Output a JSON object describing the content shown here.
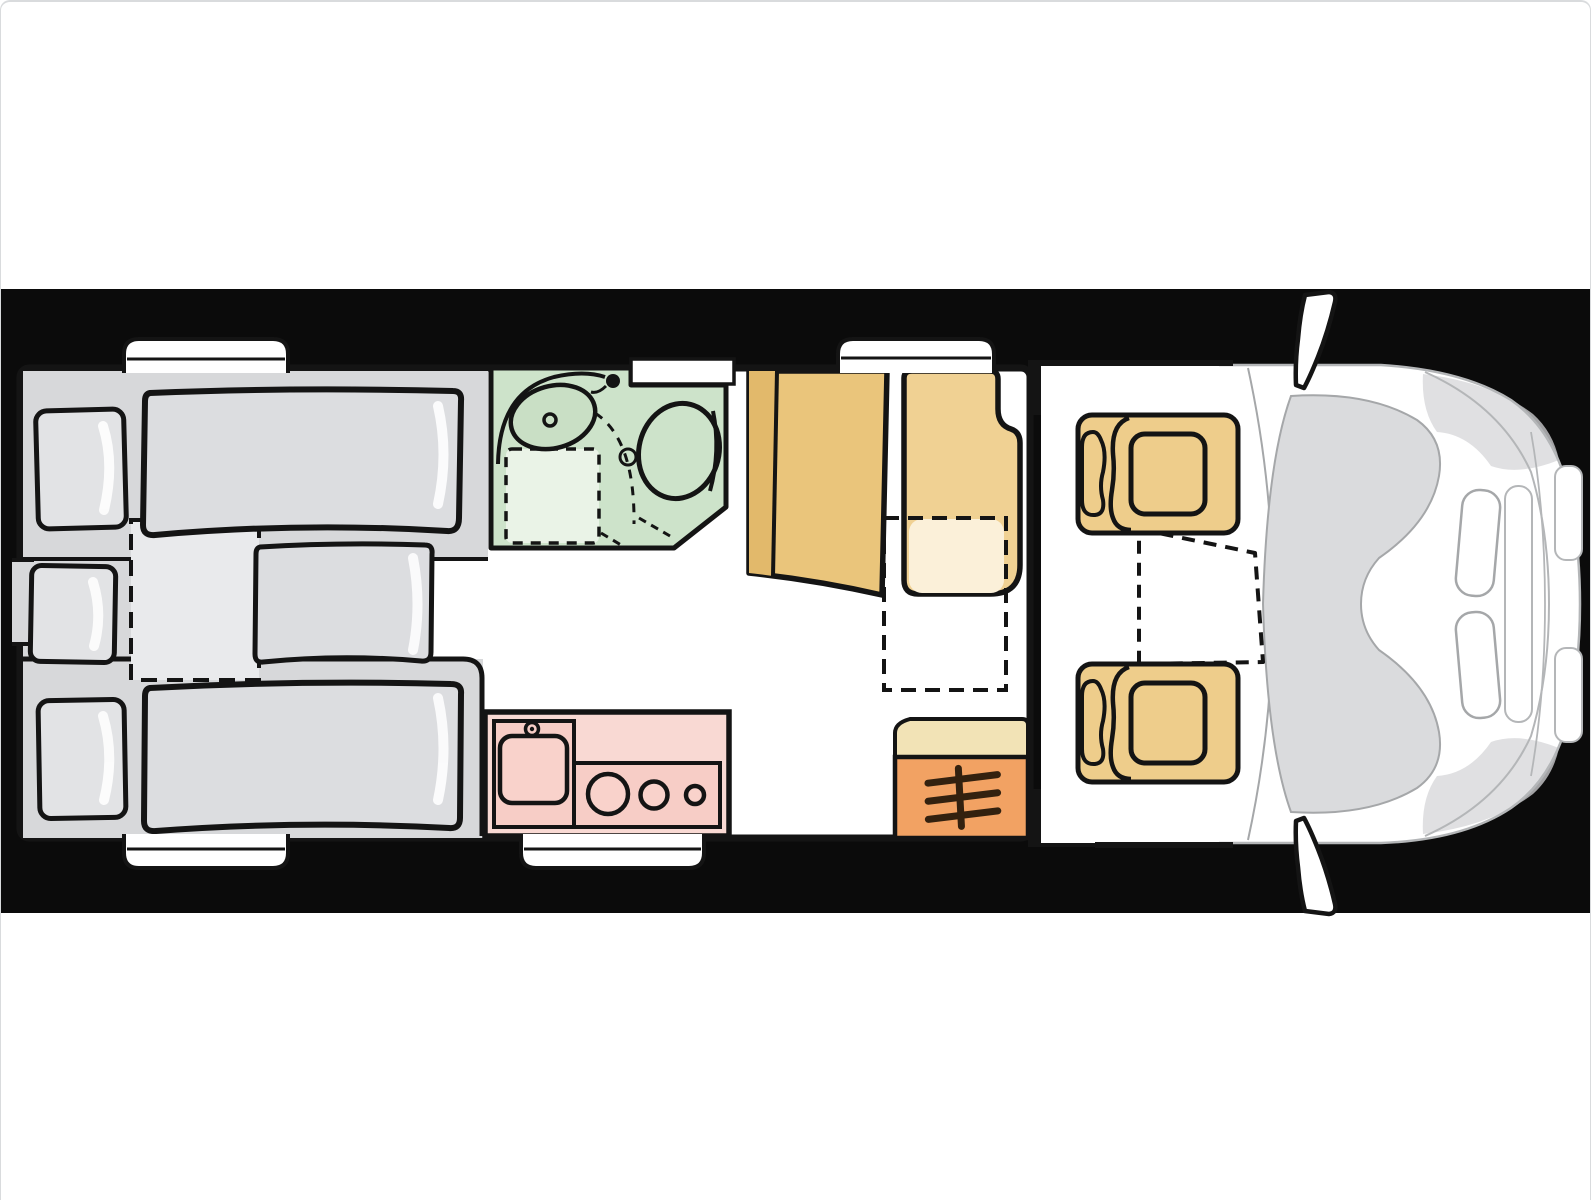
{
  "title": "Motorhome floor plan - top view with rear twin beds, bathroom, kitchen, dinette and driver cab",
  "colors": {
    "page_bg": "#ffffff",
    "page_border": "#d9dbdd",
    "band": "#0b0b0b",
    "ink": "#141414",
    "white": "#ffffff",
    "body_fill": "#ffffff",
    "bedroom_base": "#d7d8da",
    "mattress": "#dcdde0",
    "mattress_light": "#e9eaec",
    "pillow": "#e2e3e5",
    "sheen": "#ffffff",
    "bath_floor": "#cde3ca",
    "bath_fixture": "#c9dfc5",
    "bath_tray": "#eaf3e7",
    "kitchen_counter": "#f9d9d3",
    "kitchen_inner": "#f7cdc6",
    "kitchen_sink": "#f9d2cb",
    "dinette_dark": "#e2b96b",
    "dinette_mid": "#eac57b",
    "dinette_seat": "#f0d193",
    "table_fold": "#fbf0d9",
    "cab_seat": "#eecd8b",
    "heater_top": "#f2e3b6",
    "heater_orange": "#f2a263",
    "heater_symbol": "#33210f",
    "cab_outline": "#b4b6b8",
    "cab_line": "#a5a7a9",
    "windshield": "#dadbdd",
    "cab_shade": "#d5d6d8"
  },
  "zones": {
    "rear_bedroom": {
      "beds": 2,
      "pillows": 3,
      "bed_extension": "dashed outline"
    },
    "bathroom": {
      "fixtures": [
        "washbasin",
        "shower-tray",
        "toilet",
        "shower-head"
      ]
    },
    "kitchen": {
      "burners": 3,
      "fixtures": [
        "sink",
        "faucet",
        "stove"
      ]
    },
    "dinette": {
      "fixtures": [
        "sideboard-backrest",
        "travel-seat",
        "folding-table-dashed"
      ]
    },
    "heater": {
      "symbol": "heater-fins-icon"
    },
    "cab": {
      "seats": [
        "driver-swivel-seat",
        "passenger-swivel-seat"
      ],
      "fixtures": [
        "dashed-table",
        "windshield",
        "hood",
        "headlights",
        "grille",
        "side-mirrors"
      ]
    },
    "windows": [
      "rear-bedroom-top",
      "rear-left",
      "bedroom-bottom",
      "kitchen-bottom",
      "dinette-top",
      "bathroom-top"
    ]
  }
}
